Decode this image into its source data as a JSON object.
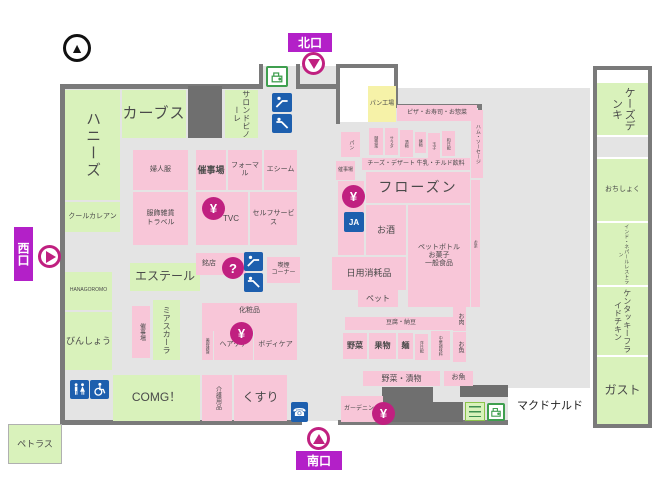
{
  "entrances": {
    "north": "北口",
    "south": "南口",
    "west": "西口"
  },
  "icon_glyphs": {
    "yen": "¥",
    "question": "?",
    "phone": "☎",
    "compass_triangle": "▲",
    "ja": "JA"
  },
  "tenants": {
    "honeys": "ハニーズ",
    "cool_carean": "クールカレアン",
    "curves": "カーブス",
    "salon_de_vinole": "サロンドビノーレ",
    "esthele": "エステール",
    "mia_scala": "ミアスカーラ",
    "hanagoromo": "HANAGOROMO",
    "binsho": "びんしょう",
    "comg": "COMG！",
    "petras": "ペトラス",
    "ks_denki": "ケーズデンキ",
    "ochishoku": "おちしょく",
    "indian_restaurant": "インド・ネパールレストラン",
    "kfc": "ケンタッキーフライドチキン",
    "gusto": "ガスト",
    "mcdonalds": "マクドナルド"
  },
  "departments": {
    "fujinfuku": "婦人服",
    "saijijo_a": "催事場",
    "formal": "フォーマル",
    "esheem": "エシーム",
    "fukushoku_travel": "服飾雑貨\nトラベル",
    "tvc": "TVC",
    "self_service": "セルフサービス",
    "meiten": "銘店",
    "kitsuen_corner": "喫煙\nコーナー",
    "keshohin": "化粧品",
    "biyo_zakka": "美容雑貨",
    "haircare": "ヘアケア",
    "bodycare": "ボディケア",
    "saijijo_b": "催事場",
    "kaigo": "介護用品",
    "kusuri": "くすり",
    "pan_kojo": "パン工場",
    "pan": "パン",
    "pizza_sushi_sozai": "ピザ・お寿司・お惣菜",
    "ham_sausage": "ハム・ソーセージ",
    "osozai": "御惣菜",
    "salad": "サラダ",
    "tsukemono": "漬物",
    "nerimono": "練物",
    "tamago": "玉子",
    "wa_nippai": "和日配",
    "cheese_milk": "チーズ・デザート 牛乳・チルド飲料",
    "saijijo_c": "催事場",
    "frozen": "フローズン",
    "osake": "お酒",
    "petbottle": "ペットボトル\nお菓子\n一般食品",
    "ocha": "お茶",
    "nichiyo_shomohin": "日用消耗品",
    "pet": "ペット",
    "tofu_natto": "豆腐・納豆",
    "yasai": "野菜",
    "kudamono": "果物",
    "men": "麺",
    "yo_nippai": "洋日配",
    "chuka_chomiryo": "中華調味料",
    "oniku": "お肉",
    "osakana": "お魚",
    "yasai_tsukemono": "野菜・漬物",
    "osakana_b": "お魚",
    "gardening": "ガーデニング"
  }
}
